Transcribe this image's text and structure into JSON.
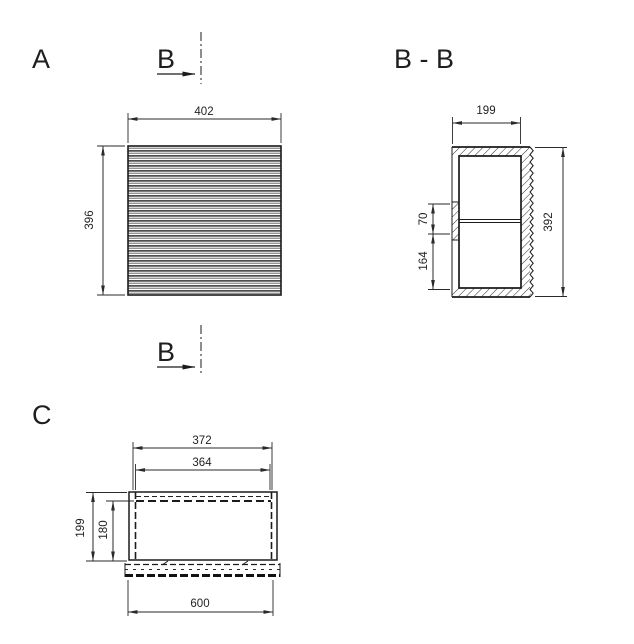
{
  "views": {
    "front": {
      "label": "A",
      "dims": {
        "width": "402",
        "height": "396"
      }
    },
    "section": {
      "label": "B - B",
      "dims": {
        "width": "199",
        "height": "392",
        "rail_height": "70",
        "rail_to_bottom": "164"
      }
    },
    "bottom": {
      "label": "C",
      "dims": {
        "opening_width": "372",
        "inner_width": "364",
        "depth": "199",
        "inner_depth": "180",
        "overall_width": "600"
      }
    }
  },
  "section_markers": {
    "top": {
      "label": "B"
    },
    "bottom": {
      "label": "B"
    }
  },
  "colors": {
    "line": "#1c1c1c",
    "dimension": "#2a2a2a",
    "background": "#ffffff"
  }
}
